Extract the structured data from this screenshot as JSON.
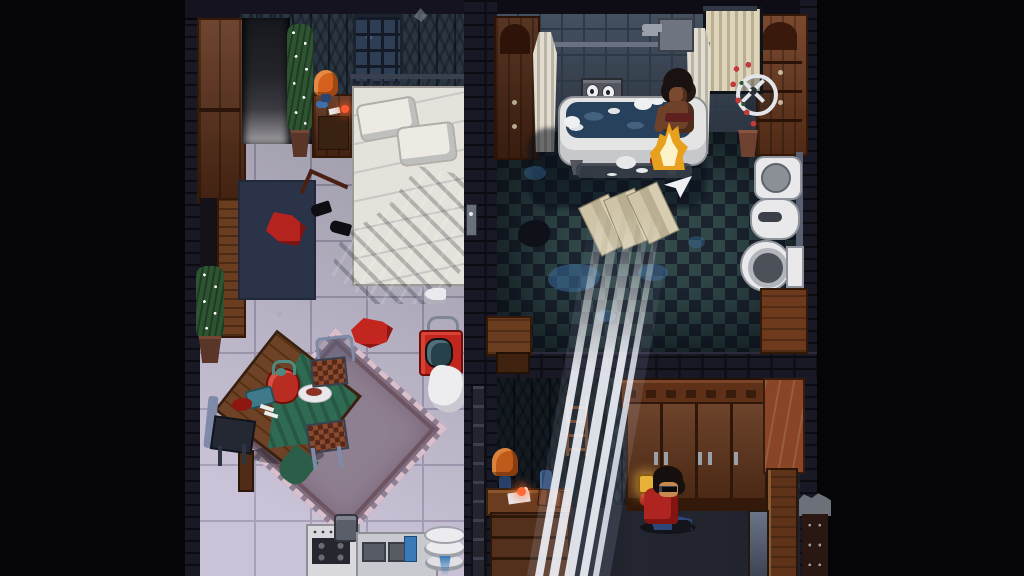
{
  "meta": {
    "type": "game-scene",
    "description": "Top-down pixel-art apartment scene: left bedroom/dining room with kitchen, upper-right bathroom with a woman bathing in a clawfoot tub beside a small fire, lower-right room with a man in a red jacket sitting against a large wardrobe while white light beams stream diagonally across the rooms",
    "resolution": "1024x576",
    "visible_text": "none"
  },
  "palette": {
    "bg": "#050507",
    "brick": "#191825",
    "wallpaper": "#2a3642",
    "wallpaper2": "#202b33",
    "floor": "#ccc9d3",
    "bath-a": "#32494a",
    "bath-b": "#1c2530",
    "wood": "#5e3018",
    "wood-light": "#8a4526",
    "red": "#b5231f",
    "orange": "#d4611e",
    "water": "#27415c",
    "green": "#2f6b52",
    "mauve": "#8e7f91",
    "metal": "#7f8aa8",
    "skin": "#7a4a30",
    "jeans": "#2d4878",
    "flame": "#f6c832",
    "plant": "#2e5432"
  },
  "rooms": {
    "left_apartment": "bedroom and dining room with kitchen",
    "bathroom": "bathroom with checkered floor",
    "lower_room": "lower bedroom with wardrobe"
  },
  "characters": {
    "woman_bathing": "woman with afro sitting in bathtub next to a small fire",
    "sitting_man": "man with sunglasses and red jacket sitting on the floor holding a glowing drink"
  },
  "objects": {
    "wardrobe_tl": "tall brown wardrobe",
    "entry_hall": "dark entry hallway",
    "entry_door": "open wooden door",
    "plant_lights": "potted plant wrapped in string lights",
    "table_lamp": "orange table lamp on nightstand",
    "nightstand": "wooden nightstand with cigarettes",
    "barred_window": "barred window",
    "bed": "double bed with white sheets and two pillows",
    "blanket": "crumpled gray blanket",
    "bedside_rug": "dark navy rug",
    "dropped_clothes": "red clothes dropped on floor",
    "high_heels": "pair of black high heels",
    "light_switch": "wall switch",
    "red_shirt": "red shirt on floor",
    "clothes_iron": "white clothes iron",
    "portable_tv": "red portable TV with handle",
    "white_towel": "white towel on floor",
    "area_rug": "fringed mauve area rug",
    "dining_table": "tilted wooden dining table",
    "tablecloth": "green tablecloth",
    "kettle": "red kettle with teal lid",
    "dinner_plate": "plate with food",
    "serving_tray": "blue serving tray",
    "blood_stain": "dark red stain",
    "chair": "metal chair with checkered seat",
    "stove": "kitchen stove with burners and pot",
    "kitchen_counter": "kitchen counter with sink basins",
    "dish_towel": "blue dish towel",
    "plate_stack": "stack of white plates",
    "shower_rail": "shower rail",
    "shower_curtain": "tied shower curtain",
    "wall_faucet": "wall-mounted faucet",
    "cistern_face": "cistern with two dial 'eyes' and spout",
    "bathtub": "white clawfoot bathtub full of water and foam",
    "fire": "small bright fire on tub edge",
    "bath_mat": "dark bath mat",
    "window_curtain": "window with cream curtain",
    "valve_wheel": "white valve wheel",
    "rose_plant": "potted climbing rose",
    "dresser_left": "dark dresser with arched panel",
    "dresser_right": "dresser with drawers",
    "wall_sink": "wall-mounted basin",
    "bidet": "bidet",
    "toilet": "toilet with tank",
    "bath_cabinet": "low wooden cabinet",
    "storage_bench": "wooden storage bench",
    "floor_towels": "beige towels laid on floor",
    "paper_plane": "paper airplane",
    "floor_hole": "dark hole in tiles",
    "puddle": "water puddle",
    "drain_pipe": "wall drain pipe",
    "ladder": "wooden ladder against wall",
    "desk": "wooden desk with drawers",
    "desk_lamp": "orange desk lamp",
    "desk_papers": "papers and burning cigarette",
    "bottle": "dark blue bottle",
    "wardrobe_large": "large four-door wardrobe",
    "side_cabinet": "tall side cabinet",
    "open_door": "open cabinet door",
    "leaning_mirror": "mirror leaning on wardrobe",
    "chimney": "brick chimney pipe",
    "light_beams": "diagonal white light beams",
    "drink": "glowing bottle in raised hand"
  }
}
